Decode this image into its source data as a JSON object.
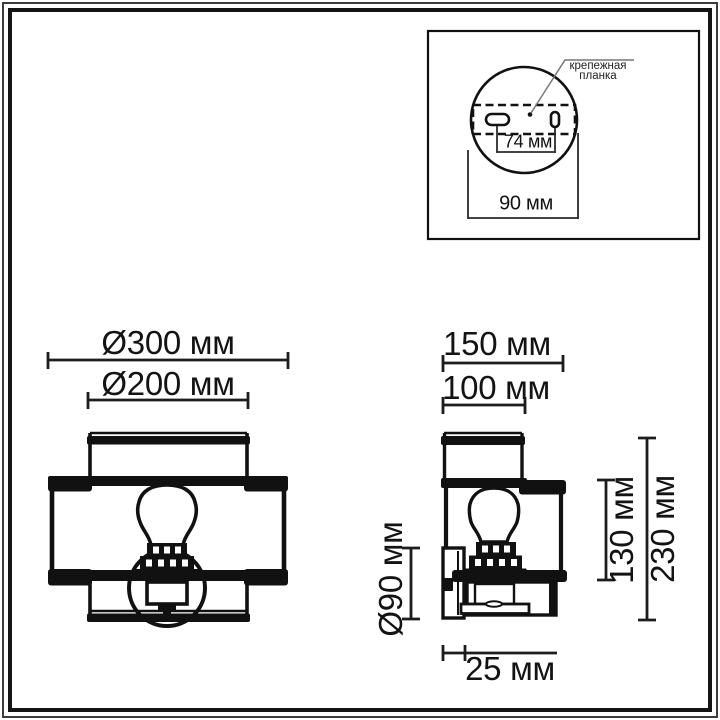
{
  "inset": {
    "label": {
      "line1": "крепежная",
      "line2": "планка"
    },
    "dim_holes": "74 мм",
    "dim_plate_width": "90 мм"
  },
  "front_view": {
    "dim_shade_outer": "Ø300 мм",
    "dim_shade_inner": "Ø200 мм"
  },
  "side_view": {
    "dim_depth_outer": "150 мм",
    "dim_depth_inner": "100 мм",
    "dim_height_shade": "130 мм",
    "dim_height_total": "230 мм",
    "dim_backplate": "Ø90 мм",
    "dim_wall_offset": "25 мм"
  }
}
